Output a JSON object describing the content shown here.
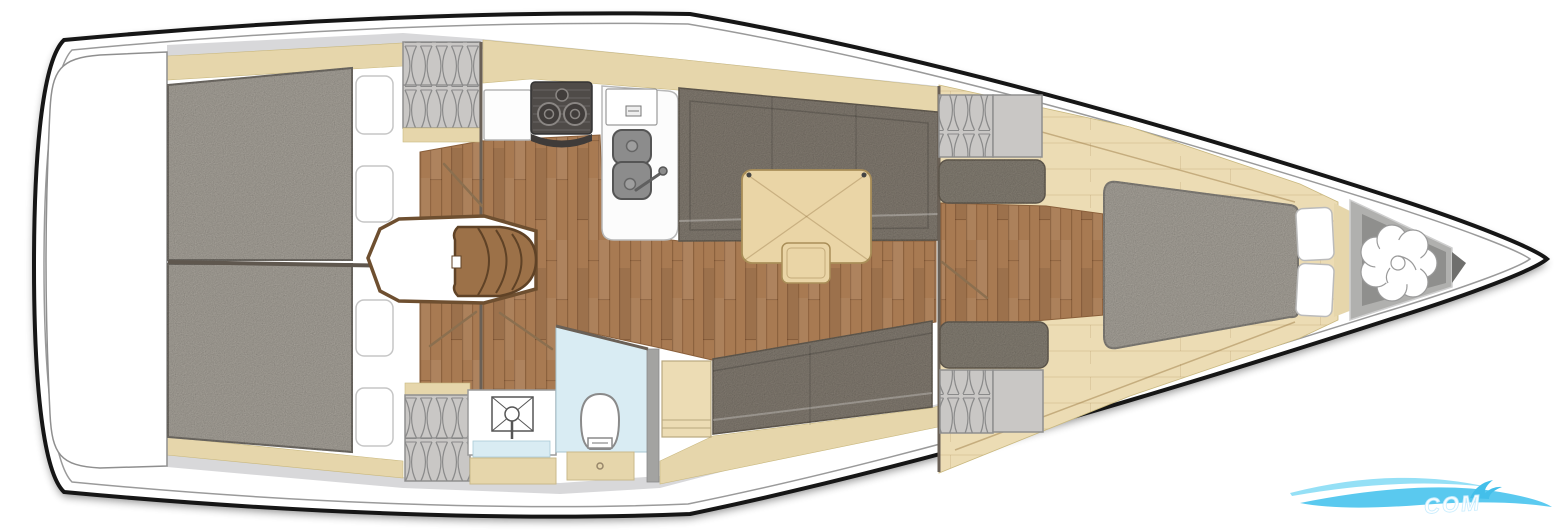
{
  "plan": {
    "type": "sailing-yacht-interior-floor-plan",
    "orientation": "bow-right-stern-left",
    "regions": [
      {
        "name": "stern-platform"
      },
      {
        "name": "aft-cabin-port-berth"
      },
      {
        "name": "aft-cabin-starboard-berth"
      },
      {
        "name": "aft-hanging-locker-port"
      },
      {
        "name": "aft-hanging-locker-starboard"
      },
      {
        "name": "companionway-stairs"
      },
      {
        "name": "galley-with-stove-and-double-sink"
      },
      {
        "name": "salon-port-settee"
      },
      {
        "name": "salon-table-with-stool"
      },
      {
        "name": "salon-starboard-settee"
      },
      {
        "name": "head-with-shower-washbasin-toilet"
      },
      {
        "name": "forward-cabin-island-berth"
      },
      {
        "name": "forward-hanging-lockers"
      },
      {
        "name": "anchor-locker-with-rode-coil"
      }
    ]
  },
  "counts": {
    "aft_pillows": 4,
    "forward_pillows": 2,
    "stove_burners": 3,
    "sink_bowls": 2
  },
  "watermark": {
    "text": "COM",
    "wave_color": "#49c4ee"
  },
  "palette": {
    "hull_stroke": "#161616",
    "deck_white": "#ffffff",
    "deck_gray": "#d8d8da",
    "wood_trim": "#e6d6ab",
    "wood_light": "#ecdcb4",
    "floor": "#a87a52",
    "floor_seam": "#6f4a28",
    "mattress": "#b4afa6",
    "mattress_edge": "#7d7871",
    "settee": "#8d857a",
    "settee_edge": "#6f675c",
    "locker_gray": "#c9c7c5",
    "locker_line": "#8a8a8a",
    "table_wood": "#ead5a6",
    "table_edge": "#a98e58",
    "stove_dark": "#4f4b48",
    "sink_gray": "#8c8c8c",
    "shower_blue": "#d9ecf3",
    "wall_dark": "#6a6056",
    "stair_wood": "#9c7148",
    "stair_line": "#5f4226",
    "anchor_gray": "#b0b0ae",
    "anchor_inner": "#8f8f8d",
    "wave_light": "#8addf6",
    "wave_main": "#49c4ee"
  }
}
